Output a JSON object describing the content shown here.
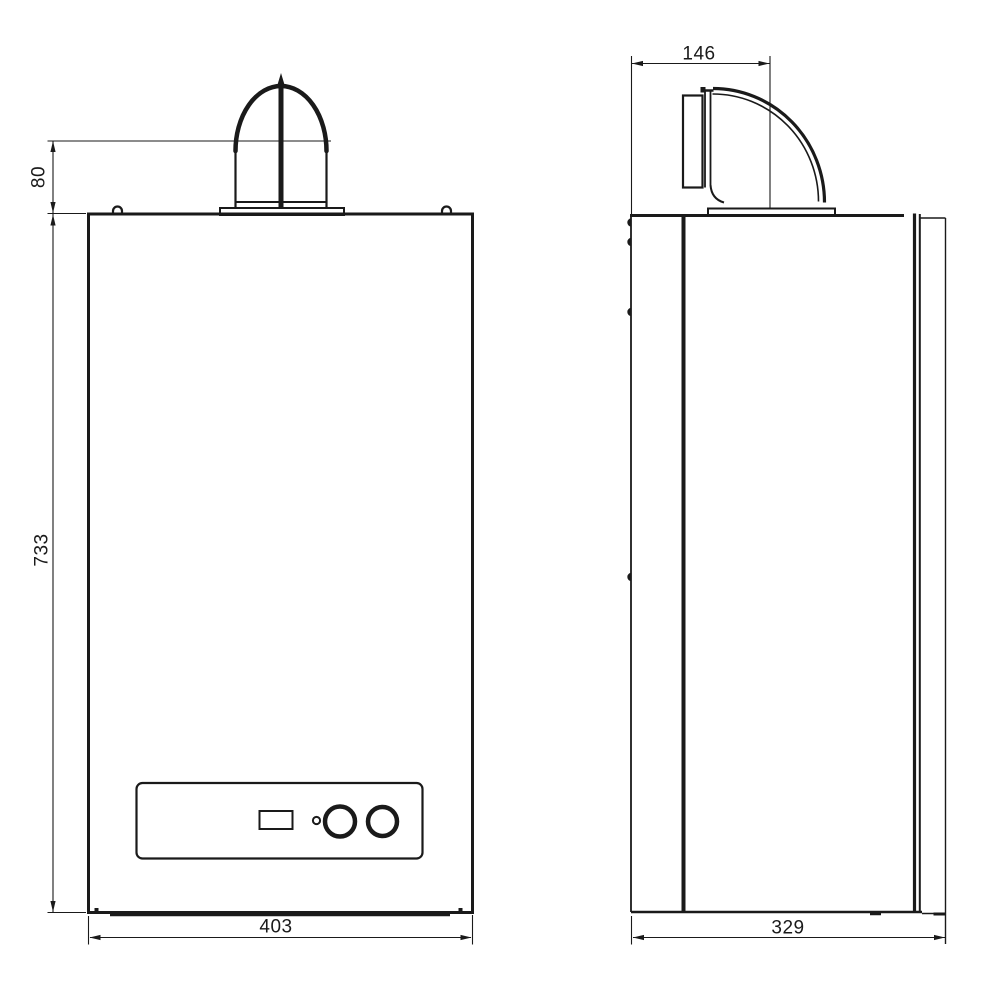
{
  "canvas": {
    "background": "#ffffff",
    "line_color": "#1a1a1a"
  },
  "drawing": {
    "views": {
      "front": {
        "name": "front-elevation"
      },
      "side": {
        "name": "side-elevation"
      }
    },
    "dimensions": {
      "flue_collar_height": {
        "value": "80",
        "orientation": "vertical"
      },
      "body_height": {
        "value": "733",
        "orientation": "vertical"
      },
      "body_width": {
        "value": "403",
        "orientation": "horizontal"
      },
      "flue_offset": {
        "value": "146",
        "orientation": "horizontal"
      },
      "body_depth": {
        "value": "329",
        "orientation": "horizontal"
      }
    }
  }
}
